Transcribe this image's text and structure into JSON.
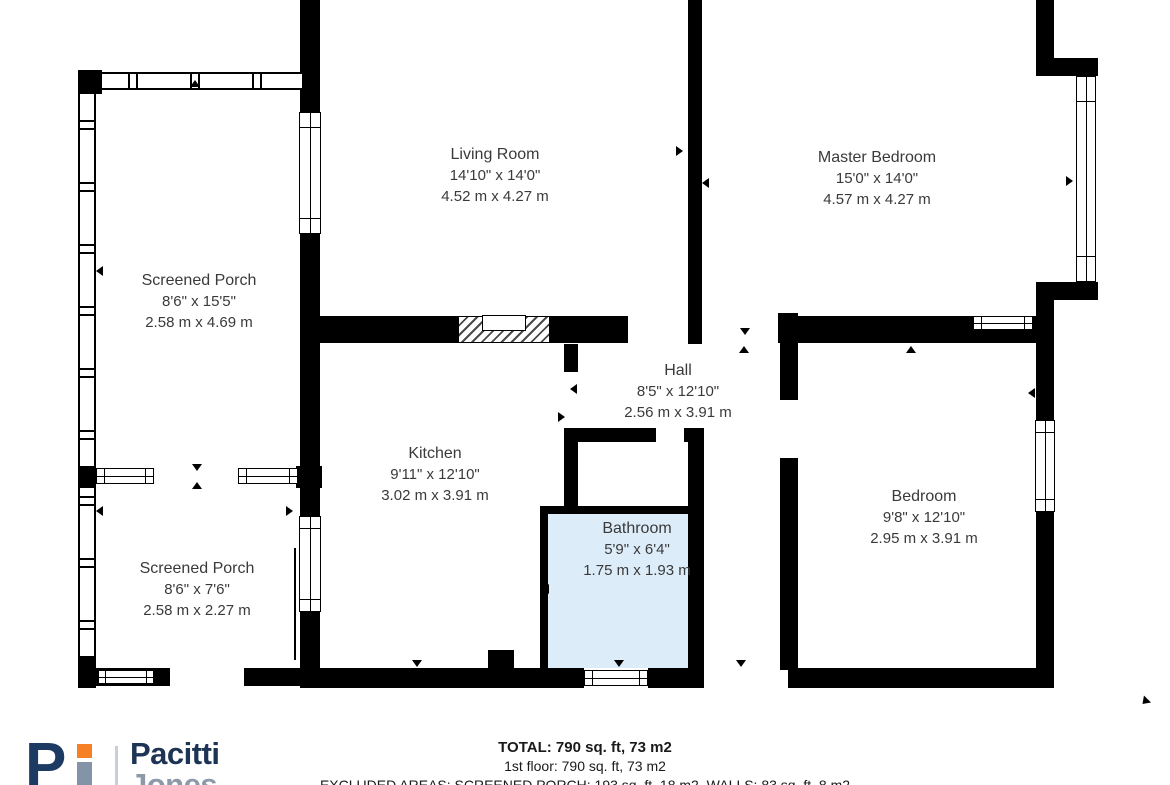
{
  "plan": {
    "highlight_color": "#dcecf8",
    "wall_color": "#000000",
    "text_color": "#3a3a3a",
    "rooms": [
      {
        "id": "screened-porch-top",
        "name": "Screened Porch",
        "imperial": "8'6\" x 15'5\"",
        "metric": "2.58 m x 4.69 m"
      },
      {
        "id": "living-room",
        "name": "Living Room",
        "imperial": "14'10\" x 14'0\"",
        "metric": "4.52 m x 4.27 m"
      },
      {
        "id": "master-bedroom",
        "name": "Master Bedroom",
        "imperial": "15'0\" x 14'0\"",
        "metric": "4.57 m x 4.27 m"
      },
      {
        "id": "hall",
        "name": "Hall",
        "imperial": "8'5\" x 12'10\"",
        "metric": "2.56 m x 3.91 m"
      },
      {
        "id": "kitchen",
        "name": "Kitchen",
        "imperial": "9'11\" x 12'10\"",
        "metric": "3.02 m x 3.91 m"
      },
      {
        "id": "bathroom",
        "name": "Bathroom",
        "imperial": "5'9\" x 6'4\"",
        "metric": "1.75 m x 1.93 m"
      },
      {
        "id": "bedroom",
        "name": "Bedroom",
        "imperial": "9'8\" x 12'10\"",
        "metric": "2.95 m x 3.91 m"
      },
      {
        "id": "screened-porch-bottom",
        "name": "Screened Porch",
        "imperial": "8'6\" x 7'6\"",
        "metric": "2.58 m x 2.27 m"
      }
    ]
  },
  "footer": {
    "total_line": "TOTAL: 790 sq. ft, 73 m2",
    "floor_line": "1st floor: 790 sq. ft, 73 m2",
    "excluded_line": "EXCLUDED AREAS: SCREENED PORCH: 193 sq. ft, 18 m2, WALLS: 83 sq. ft, 8 m2"
  },
  "logo": {
    "monogram_p": "P",
    "name_top": "Pacitti",
    "name_bottom": "Jones",
    "navy": "#1d3455",
    "orange": "#f58025",
    "gray": "#8d99a8"
  }
}
